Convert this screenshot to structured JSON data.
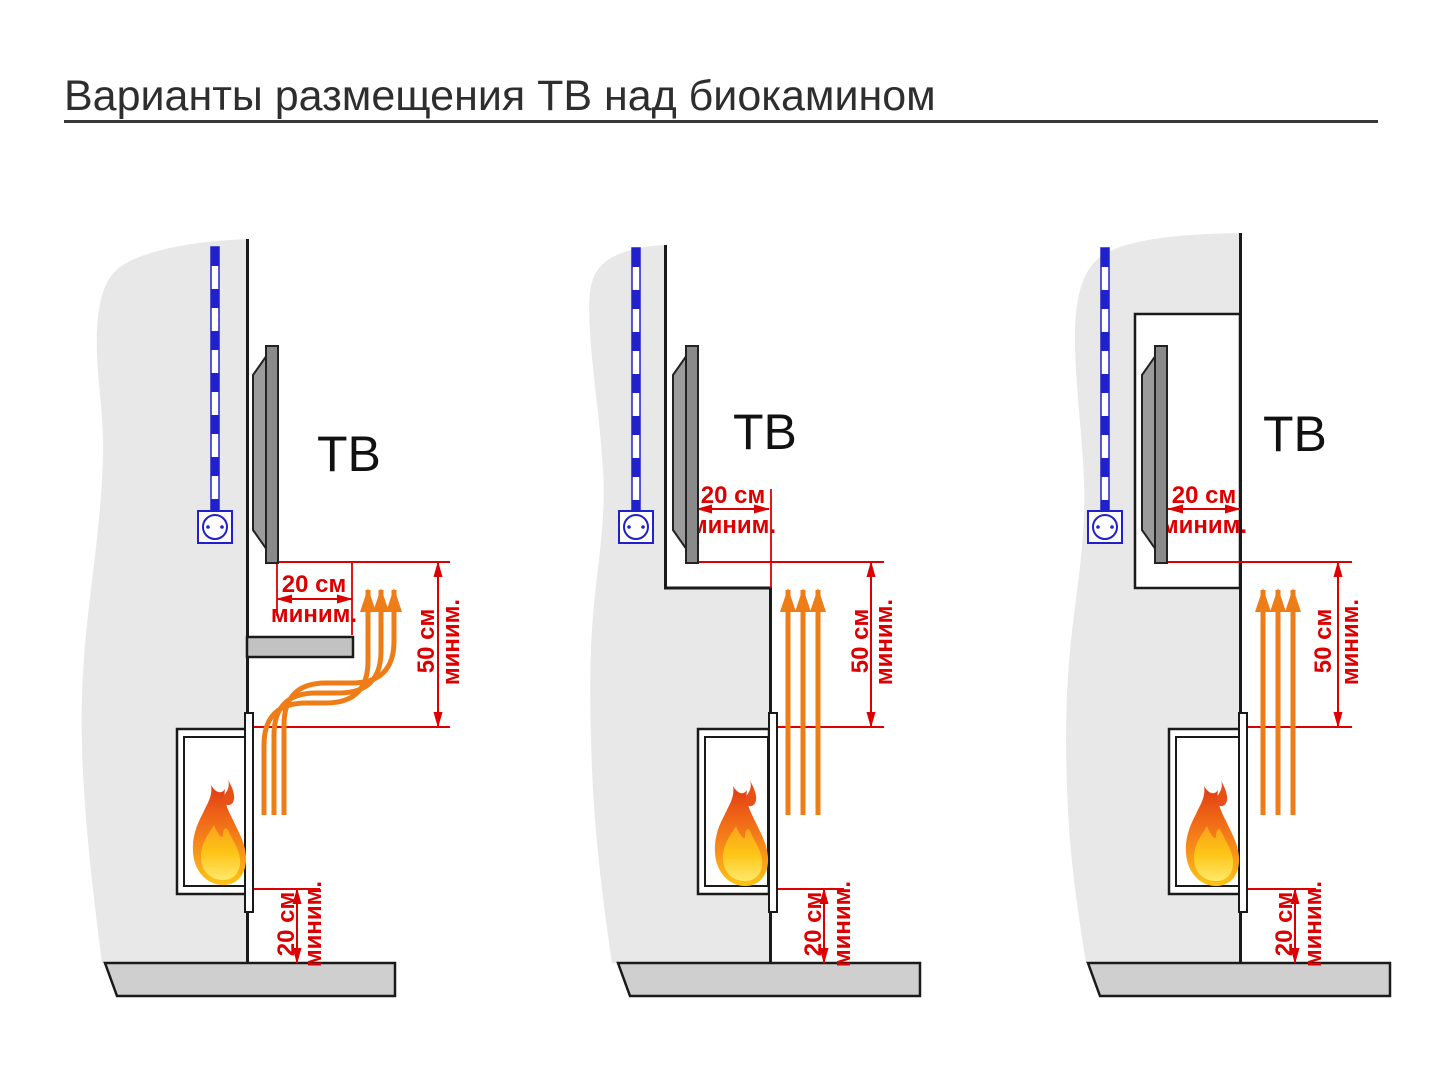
{
  "title": "Варианты размещения ТВ над биокамином",
  "panels": [
    {
      "tv_label": "ТВ",
      "side_clearance": {
        "value": "20 см",
        "qualifier": "миним."
      },
      "vertical_clearance": {
        "value": "50 см",
        "qualifier": "миним."
      },
      "floor_clearance": {
        "value": "20 см",
        "qualifier": "миним."
      }
    },
    {
      "tv_label": "ТВ",
      "side_clearance": {
        "value": "20 см",
        "qualifier": "миним."
      },
      "vertical_clearance": {
        "value": "50 см",
        "qualifier": "миним."
      },
      "floor_clearance": {
        "value": "20 см",
        "qualifier": "миним."
      }
    },
    {
      "tv_label": "ТВ",
      "side_clearance": {
        "value": "20 см",
        "qualifier": "миним."
      },
      "vertical_clearance": {
        "value": "50 см",
        "qualifier": "миним."
      },
      "floor_clearance": {
        "value": "20 см",
        "qualifier": "миним."
      }
    }
  ],
  "colors": {
    "dimension_red": "#dd0000",
    "heat_orange": "#ee7d18",
    "cable_blue": "#2121cc",
    "wall_gray": "#e8e8e8",
    "floor_gray": "#cfcfcf",
    "tv_gray": "#8a8a8a",
    "flame_top": "#e03a12",
    "flame_bottom": "#fdc515",
    "outline_dark": "#1a1a1a"
  }
}
